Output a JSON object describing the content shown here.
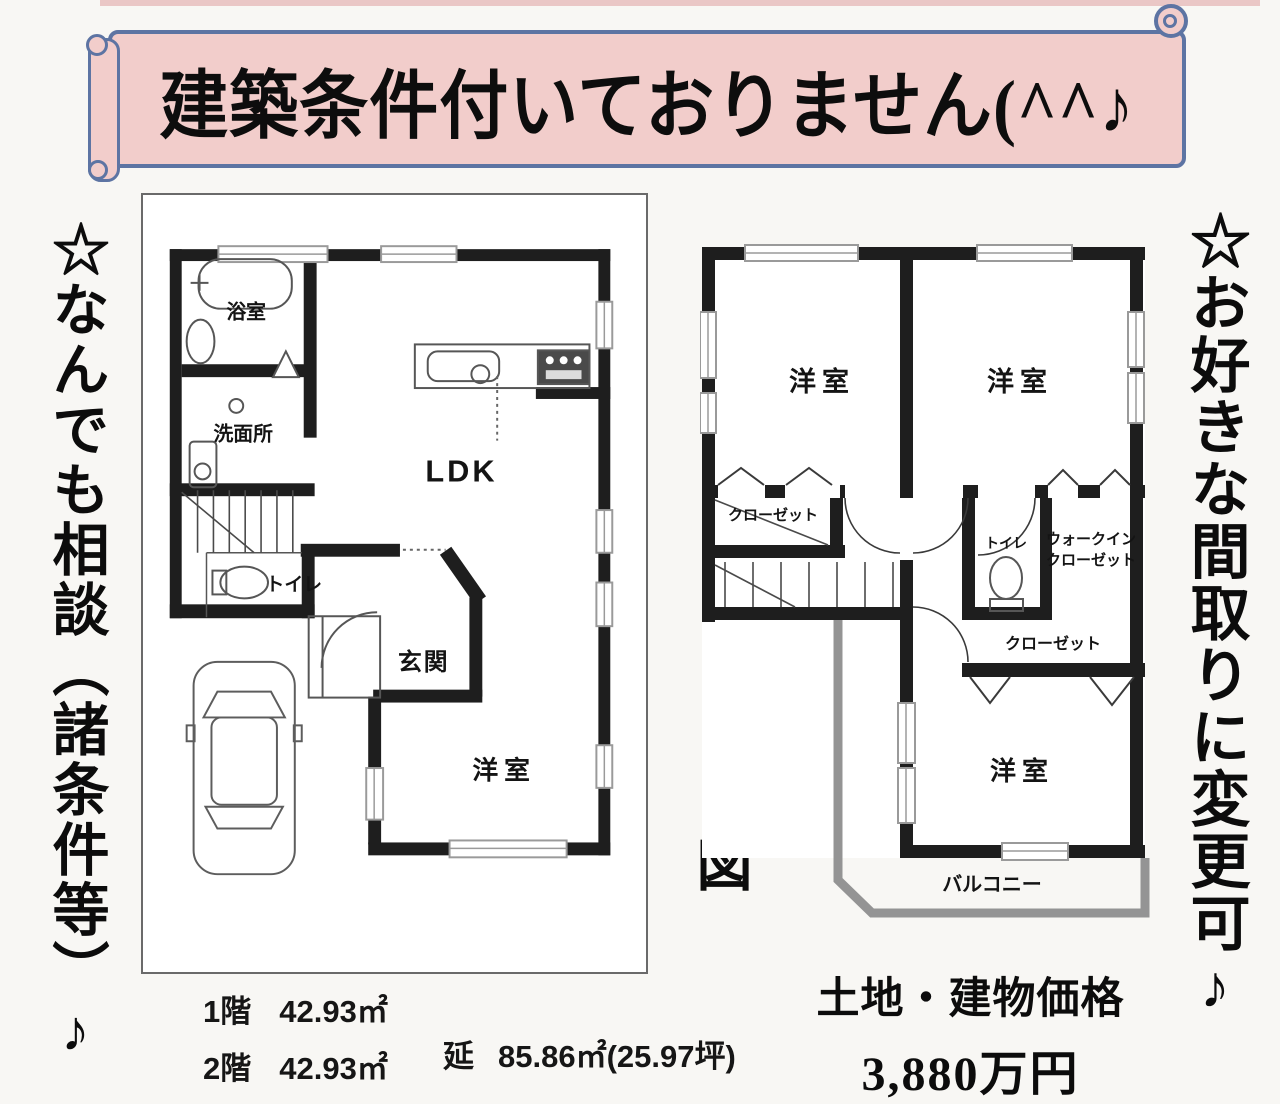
{
  "banner": {
    "text": "建築条件付いておりません(^^♪"
  },
  "notes": {
    "left": "☆なんでも相談（諸条件等）♪",
    "right": "☆お好きな間取りに変更可♪"
  },
  "plan_title": "プラン図",
  "floor1": {
    "bath": "浴室",
    "washroom": "洗面所",
    "ldk": "LDK",
    "toilet": "トイレ",
    "entrance": "玄関",
    "bedroom": "洋室"
  },
  "floor2": {
    "bedroom1": "洋室",
    "bedroom2": "洋室",
    "bedroom3": "洋室",
    "closet_left": "クローゼット",
    "closet_bottom": "クローゼット",
    "toilet": "トイレ",
    "wic_line1": "ウォークイン",
    "wic_line2": "クローゼット",
    "balcony": "バルコニー"
  },
  "areas": {
    "rows": [
      {
        "label": "1階",
        "value": "42.93㎡"
      },
      {
        "label": "2階",
        "value": "42.93㎡"
      }
    ],
    "total_label": "延",
    "total_value": "85.86㎡(25.97坪)"
  },
  "price": {
    "label": "土地・建物価格",
    "value": "3,880万円"
  },
  "colors": {
    "banner_bg": "#f2cdcb",
    "banner_border": "#5d74a3",
    "wall": "#1e1e1e",
    "balcony_rail": "#949494"
  }
}
